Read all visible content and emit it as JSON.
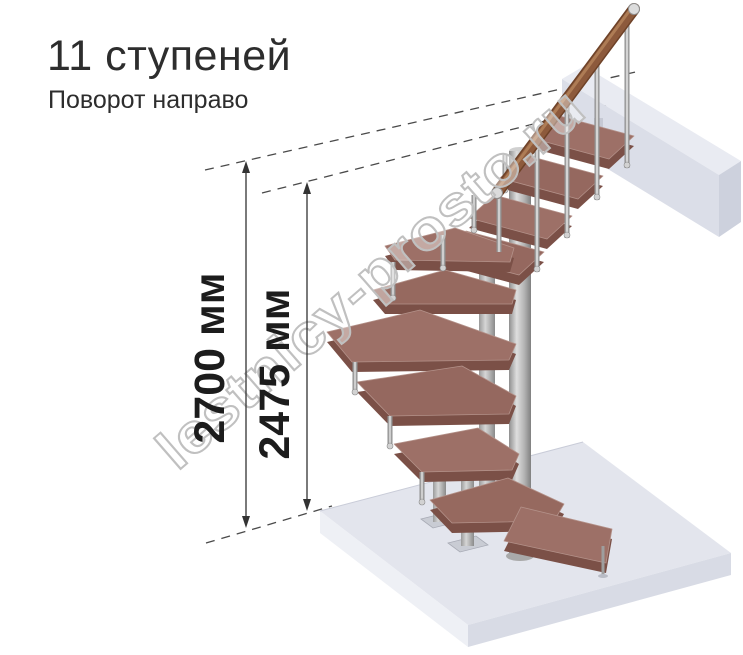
{
  "header": {
    "title": "11 ступеней",
    "subtitle": "Поворот направо"
  },
  "dimensions": {
    "outer_label": "2700 мм",
    "inner_label": "2475 мм"
  },
  "watermark": {
    "text": "lestnicy-prosto.ru"
  },
  "colors": {
    "step_wood_top": "#9d7067",
    "step_wood_side": "#7b5047",
    "handrail_wood": "#8d5a3c",
    "metal": "#ababab",
    "floor_slab": "#e3e5ed",
    "landing_beam": "#dbdee8",
    "dimension_ink": "#1c1c1c",
    "watermark_gray": "#c0c0c0"
  }
}
